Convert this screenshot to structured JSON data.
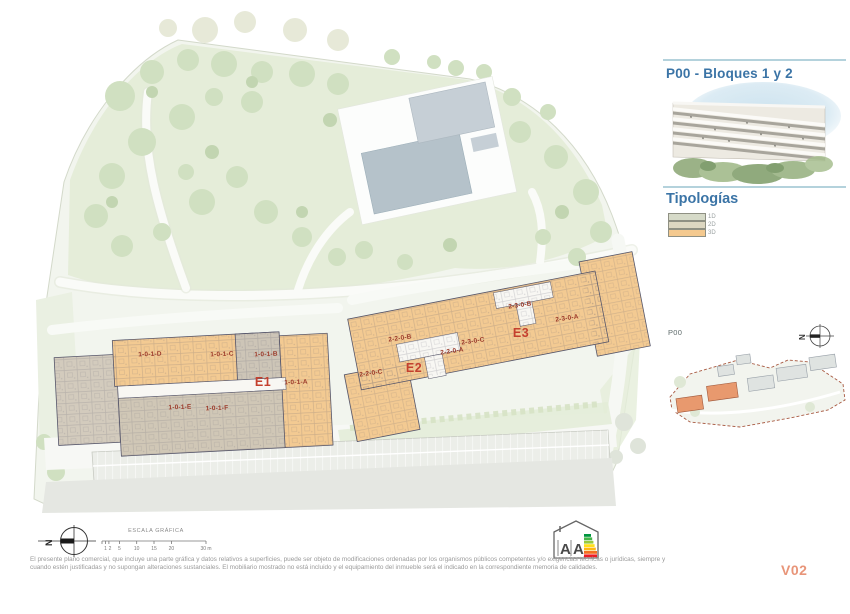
{
  "document": {
    "version": "V02"
  },
  "panel": {
    "title": "P00 - Bloques 1 y 2",
    "typologies_heading": "Tipologías",
    "typologies": [
      {
        "label": "1D",
        "color": "#d6dac8"
      },
      {
        "label": "2D",
        "color": "#ddd7c1"
      },
      {
        "label": "3D",
        "color": "#f4c98f"
      }
    ],
    "minimap": {
      "plan_label": "P00",
      "north_label": "N"
    }
  },
  "site_plan": {
    "blocks": [
      {
        "label": "E1"
      },
      {
        "label": "E2"
      },
      {
        "label": "E3"
      }
    ],
    "units": [
      {
        "label": "1-0-1-D"
      },
      {
        "label": "1-0-1-C"
      },
      {
        "label": "1-0-1-B"
      },
      {
        "label": "1-0-1-A"
      },
      {
        "label": "1-0-1-E"
      },
      {
        "label": "1-0-1-F"
      },
      {
        "label": "2-2-0-B"
      },
      {
        "label": "2-2-0-A"
      },
      {
        "label": "2-2-0-C"
      },
      {
        "label": "2-3-0-B"
      },
      {
        "label": "2-3-0-C"
      },
      {
        "label": "2-3-0-A"
      }
    ]
  },
  "footer": {
    "north_label": "N",
    "scale_heading": "ESCALA GRÁFICA",
    "scale_ticks": [
      "1",
      "2",
      "5",
      "10",
      "15",
      "20",
      "30 m"
    ],
    "disclaimer_line1": "El presente plano comercial, que incluye una parte gráfica y datos relativos a superficies, puede ser objeto de modificaciones ordenadas por los organismos públicos competentes y/o exigencias técnicas o jurídicas, siempre y",
    "disclaimer_line2": "cuando estén justificadas y no supongan alteraciones sustanciales. El mobiliario mostrado no está incluido y el equipamiento del inmueble será el indicado en la correspondiente memoria de calidades.",
    "energy_letters": [
      "A",
      "A"
    ]
  }
}
